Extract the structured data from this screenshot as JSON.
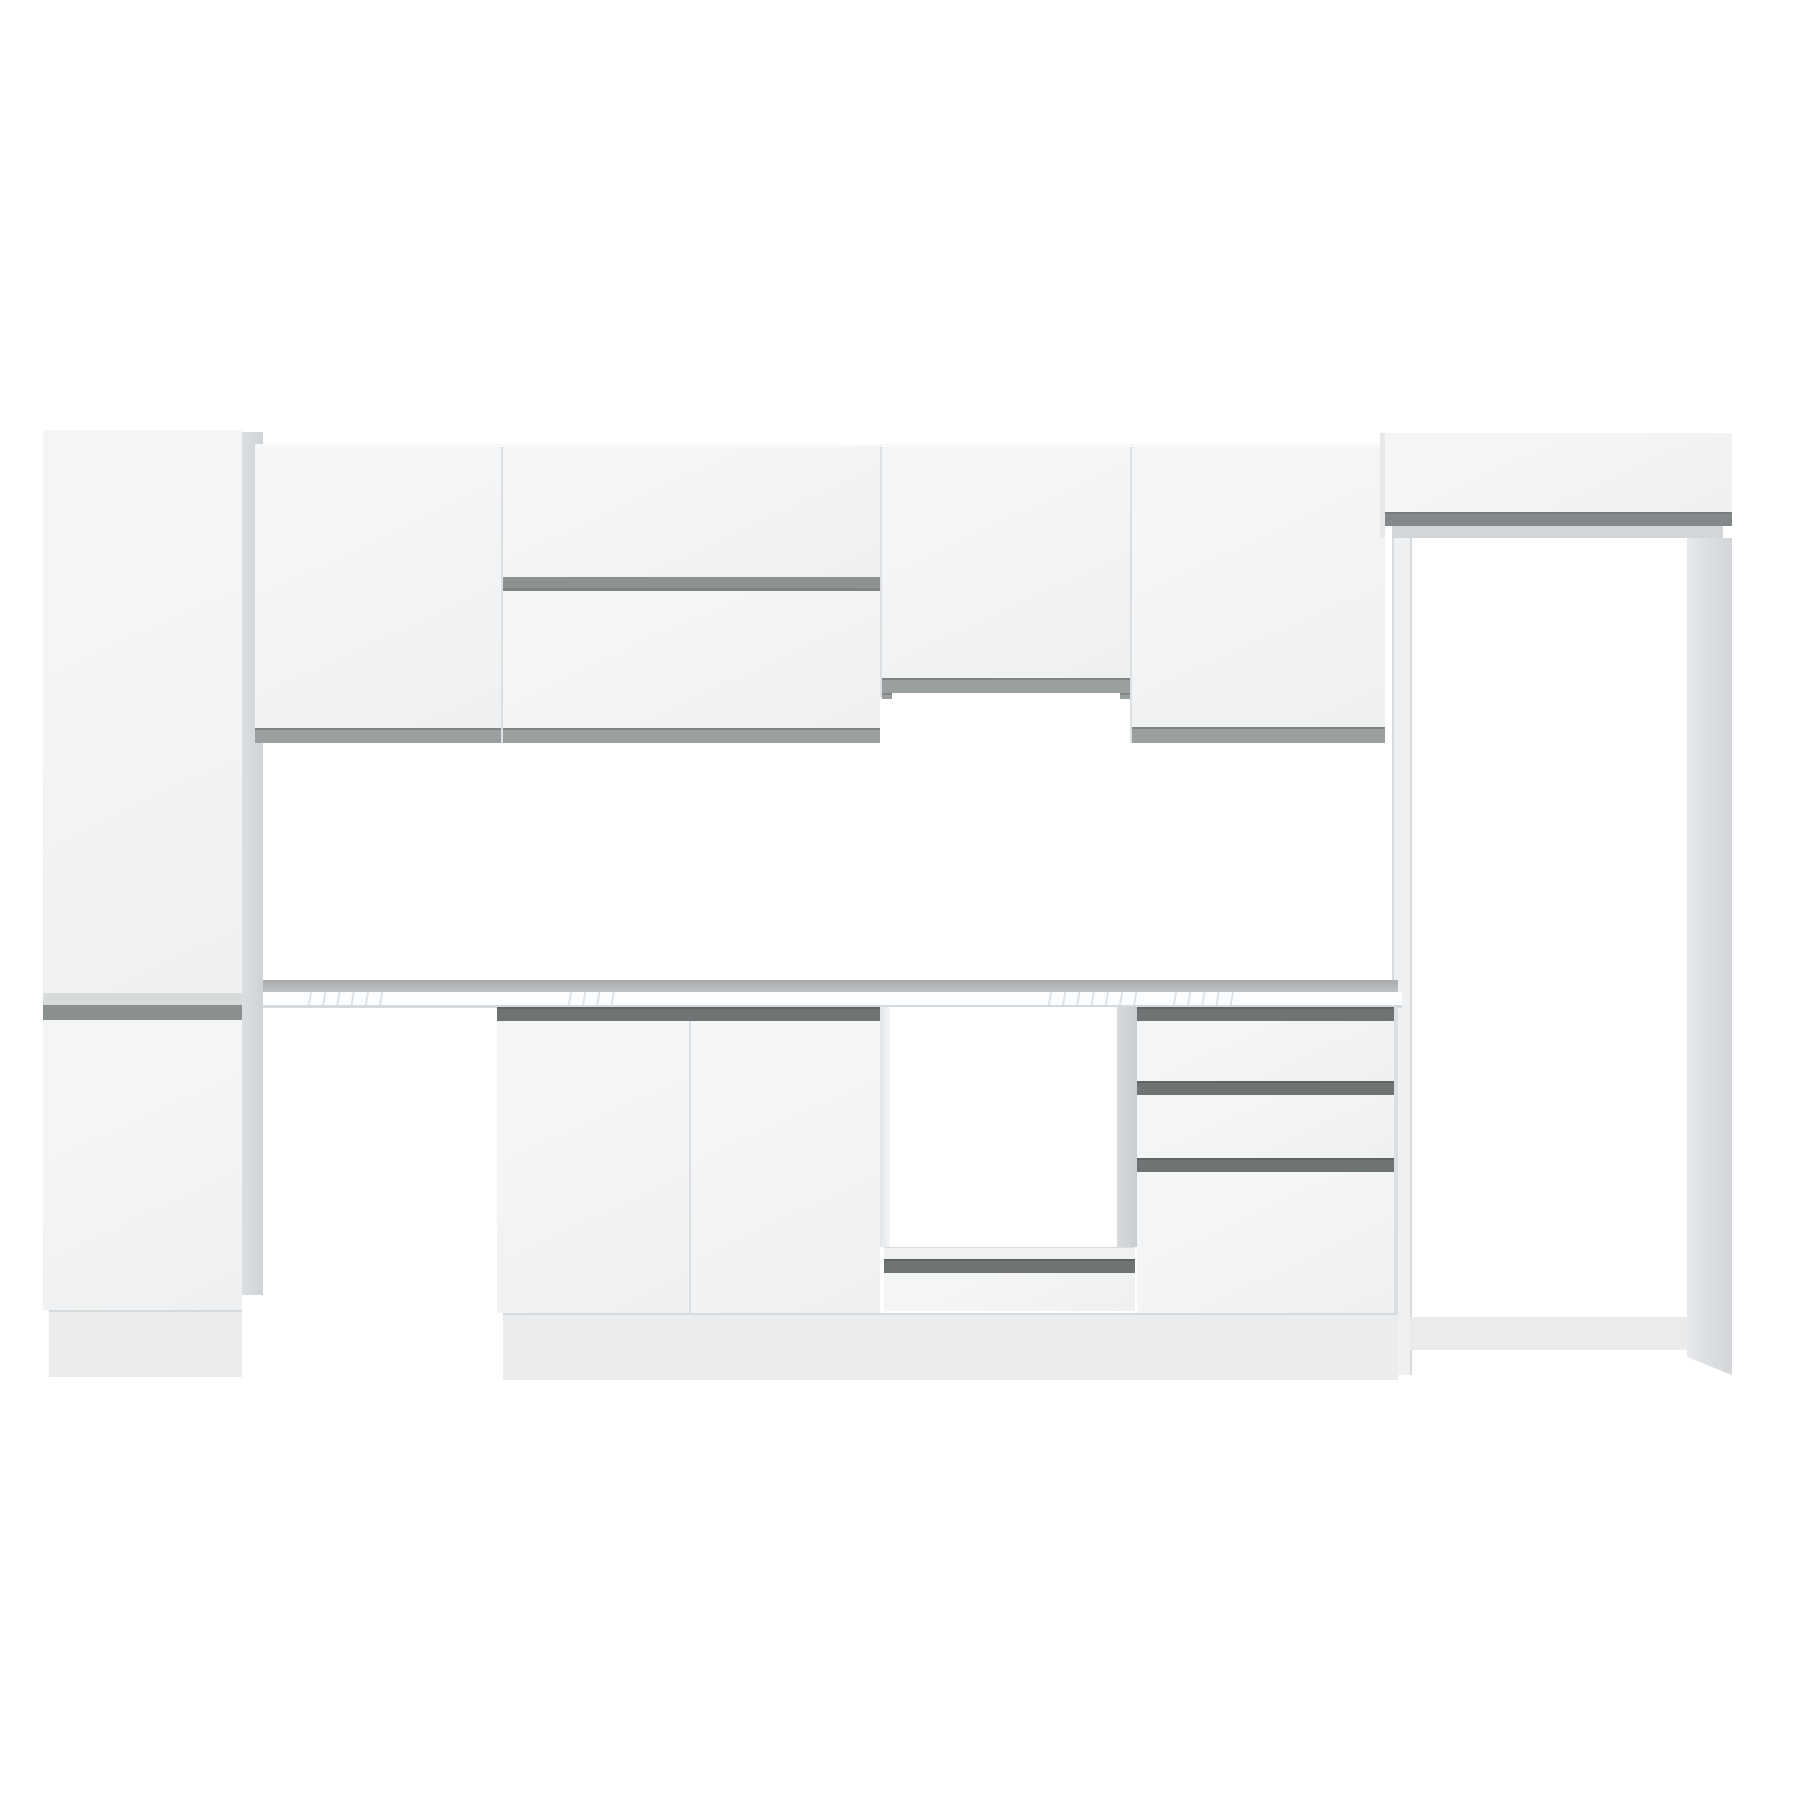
{
  "product": {
    "kind": "kitchen-cabinet-set-product-image",
    "finish": "white",
    "background": "#ffffff"
  },
  "palette": {
    "bg": "#ffffff",
    "door_hi": "#f4f5f6",
    "door_lo": "#eef0f1",
    "divider": "#dde0e2",
    "side_hi": "#dcdfe1",
    "side_lo": "#cfd3d6",
    "strip_upper": "#9aa09f",
    "strip_upper_edge": "#7f8584",
    "strip_mid": "#8d9291",
    "strip_base": "#6e7473",
    "strip_fridge": "#83888a",
    "strip_tall_light": "#d8dbdb",
    "strip_tall_dark": "#8a8f8f",
    "rail_light": "#d3d6d8",
    "stile": "#eef0f1",
    "stile_edge": "#d9dcde",
    "stile_side_hi": "#e6e8ea",
    "stile_side_lo": "#d2d6d9",
    "plinth": "#eaecee",
    "plinth_line": "#d7dadc",
    "counter_back_hi": "#a7abad",
    "counter_back_lo": "#bfc3c5",
    "slab": "#fcfdfe",
    "slab_edge": "#d6d9db",
    "vein": "#c9ced3",
    "inner_left": "#e3e6e8",
    "inner_right_hi": "#d8dbdd",
    "inner_right_lo": "#c8ccd0",
    "shelf": "#eff1f3",
    "bay_white": "#ffffff",
    "bay_plinth": "#e9ebed"
  },
  "parts": {
    "tall_cabinet": "Tall pantry cabinet, two doors with recessed grip rail",
    "tall_cabinet_upper_door": "Tall cabinet upper door",
    "tall_cabinet_lower_door": "Tall cabinet lower door",
    "wall_cabinet_a": "Wall cabinet, single door",
    "wall_cabinet_b": "Wall cabinet, two horizontal flap doors with grip rail",
    "wall_cabinet_c": "Short wall cabinet over hood space",
    "wall_cabinet_d": "Wall cabinet, single wide door",
    "over_fridge_cabinet": "Cabinet above refrigerator bay",
    "fridge_frame": "Open refrigerator bay frame",
    "countertop": "Marble-look countertop",
    "base_door_cabinet": "Base cabinet, two doors",
    "oven_bay": "Open bay for built-in oven with bottom drawer",
    "drawer_unit": "Base unit with three drawers",
    "plinth": "Recessed plinth"
  }
}
